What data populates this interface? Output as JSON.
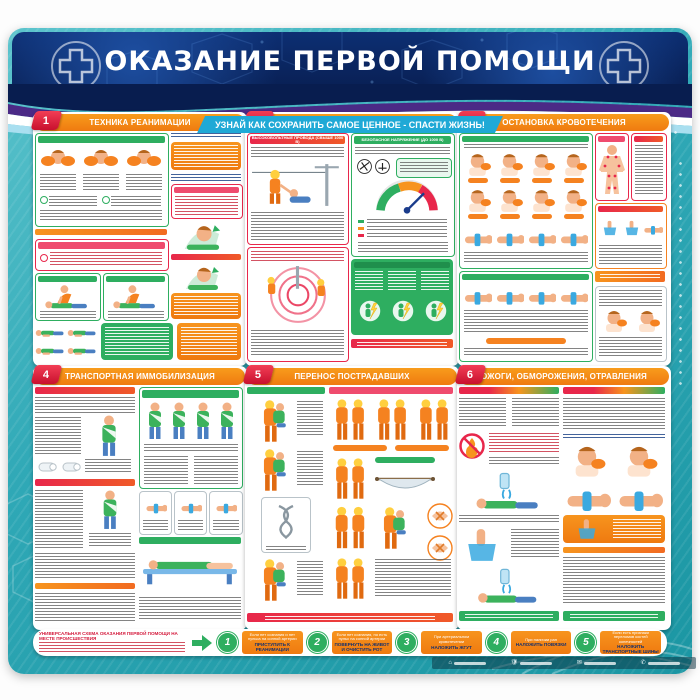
{
  "header": {
    "title": "ОКАЗАНИЕ ПЕРВОЙ ПОМОЩИ",
    "banner": "УЗНАЙ КАК СОХРАНИТЬ САМОЕ ЦЕННОЕ - СПАСТИ ЖИЗНЬ!"
  },
  "panels": [
    {
      "number": "1",
      "title": "ТЕХНИКА РЕАНИМАЦИИ"
    },
    {
      "number": "2",
      "title": "ЭЛЕКТРОТРАВМЫ",
      "left_header": "ВЫСОКОВОЛЬТНЫЕ ПРОВОДА (СВЫШЕ 1000 В)",
      "right_header": "БЕЗОПАСНОЕ НАПРЯЖЕНИЕ (ДО 1000 В)"
    },
    {
      "number": "3",
      "title": "ОСТАНОВКА КРОВОТЕЧЕНИЯ"
    },
    {
      "number": "4",
      "title": "ТРАНСПОРТНАЯ ИММОБИЛИЗАЦИЯ"
    },
    {
      "number": "5",
      "title": "ПЕРЕНОС ПОСТРАДАВШИХ"
    },
    {
      "number": "6",
      "title": "ОЖОГИ, ОБМОРОЖЕНИЯ, ОТРАВЛЕНИЯ"
    }
  ],
  "scheme": {
    "title": "УНИВЕРСАЛЬНАЯ СХЕМА ОКАЗАНИЯ ПЕРВОЙ ПОМОЩИ НА МЕСТЕ ПРОИСШЕСТВИЯ",
    "steps": [
      {
        "num": "1",
        "condition": "Если нет сознания и нет пульса на сонной артерии",
        "action": "ПРИСТУПИТЬ К РЕАНИМАЦИИ"
      },
      {
        "num": "2",
        "condition": "Если нет сознания, но есть пульс на сонной артерии",
        "action": "ПОВЕРНУТЬ НА ЖИВОТ И ОЧИСТИТЬ РОТ"
      },
      {
        "num": "3",
        "condition": "При артериальном кровотечении",
        "action": "НАЛОЖИТЬ ЖГУТ"
      },
      {
        "num": "4",
        "condition": "При наличии ран",
        "action": "НАЛОЖИТЬ ПОВЯЗКИ"
      },
      {
        "num": "5",
        "condition": "Если есть признаки переломов костей конечностей",
        "action": "НАЛОЖИТЬ ТРАНСПОРТНЫЕ ШИНЫ"
      }
    ]
  },
  "colors": {
    "accent_orange": "#f58220",
    "accent_red": "#e8274b",
    "accent_green": "#2eae60",
    "teal": "#2fa8b6",
    "navy": "#0a2a66",
    "cyan": "#1fa9d6"
  }
}
